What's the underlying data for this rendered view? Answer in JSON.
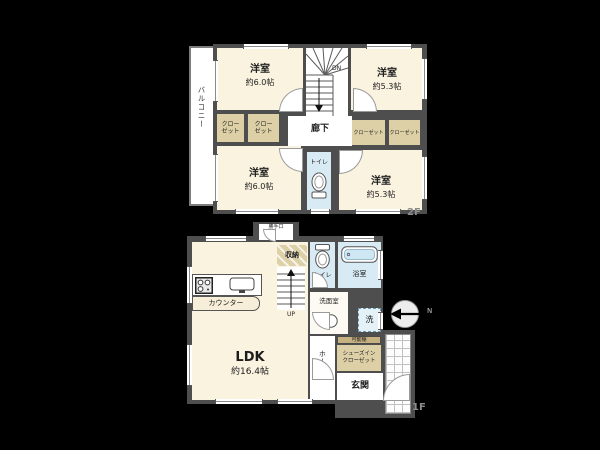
{
  "floor2": {
    "label": "2F",
    "balcony": "バルコニー",
    "corridor": "廊下",
    "toilet": "トイレ",
    "stairs_direction": "DN",
    "rooms": {
      "tl": {
        "name": "洋室",
        "size": "約6.0帖"
      },
      "tr": {
        "name": "洋室",
        "size": "約5.3帖"
      },
      "bl": {
        "name": "洋室",
        "size": "約6.0帖"
      },
      "br": {
        "name": "洋室",
        "size": "約5.3帖"
      }
    },
    "closet_small": {
      "line1": "クロー",
      "line2": "ゼット"
    },
    "closet_wide": "クローゼット"
  },
  "floor1": {
    "label": "1F",
    "ldk": {
      "name": "LDK",
      "size": "約16.4帖"
    },
    "counter": "カウンター",
    "storage": "収納",
    "toilet": "トイレ",
    "bath": "浴室",
    "washroom": "洗面室",
    "washer": "洗",
    "movable_shelf": "可動棚",
    "shoe_closet": {
      "line1": "シューズイン",
      "line2": "クローゼット"
    },
    "hall": "ホール",
    "entrance": "玄関",
    "stairs_direction": "UP",
    "back_door": "勝手口"
  },
  "compass": {
    "label": "N"
  },
  "palette": {
    "background": "#000000",
    "wall": "#4e4e4e",
    "room_cream": "#faf3e0",
    "closet_beige": "#ddd0a6",
    "wet_blue": "#d8eaf3",
    "floor_tag_gray": "#8c8c8c"
  }
}
